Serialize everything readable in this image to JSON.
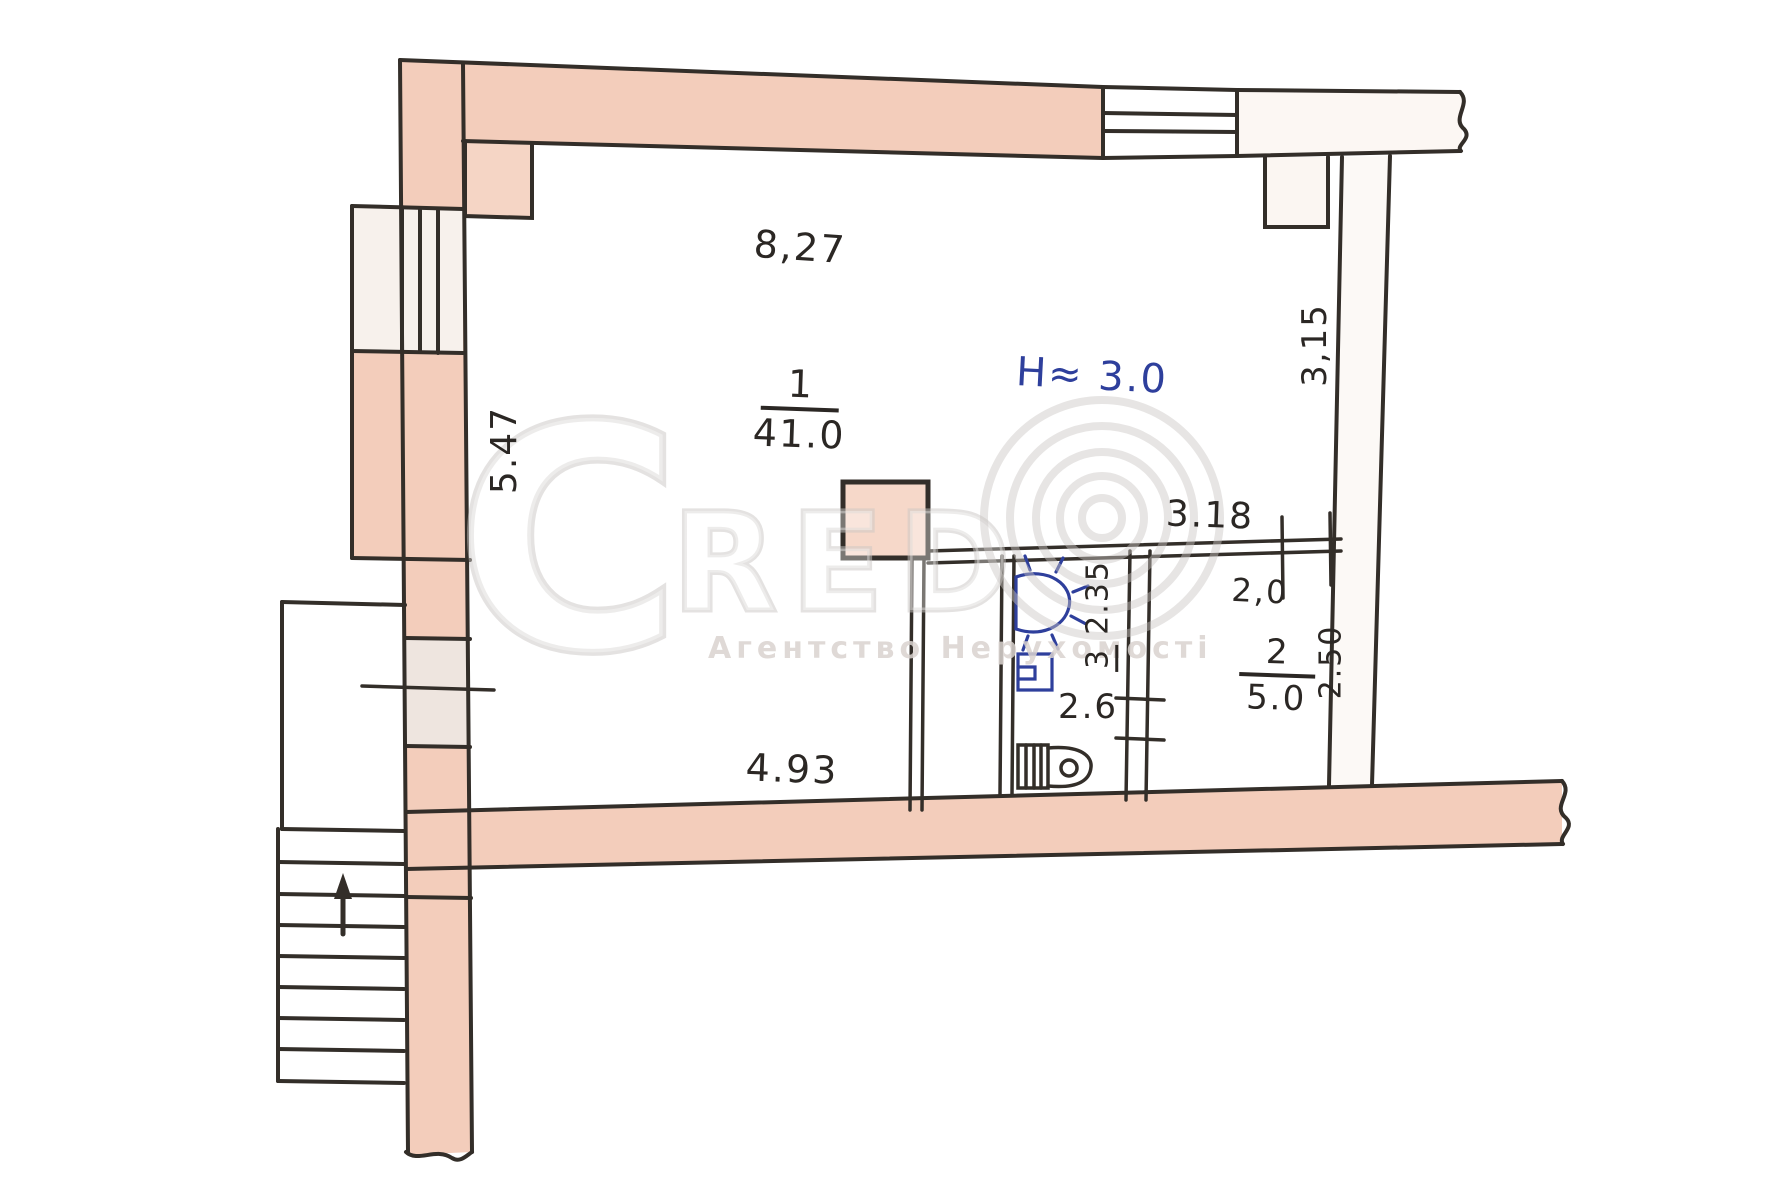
{
  "plan": {
    "room1": {
      "number": "1",
      "area": "41.0"
    },
    "room2": {
      "number": "2",
      "area": "5.0"
    },
    "room3": {
      "number": "3",
      "area": "2.35"
    },
    "dims": {
      "top_width": "8,27",
      "left_height": "5.47",
      "right_height": "3,15",
      "bottom_width": "4.93",
      "inner_wall_top": "3.18",
      "inner_wall_sub": "2,0",
      "wc_width": "2.6",
      "room2_depth": "2.50"
    },
    "annotations": {
      "ceiling_height": "H≈ 3.0"
    },
    "watermark": {
      "logo_c": "C",
      "logo_red": "RED",
      "agency": "Агентство Нерухомості"
    },
    "colors": {
      "ink": "#332e29",
      "blue_ink": "#2e3f9c",
      "wall_fill": "#f3cdbb",
      "watermark_gray": "#c9c5c3"
    }
  }
}
